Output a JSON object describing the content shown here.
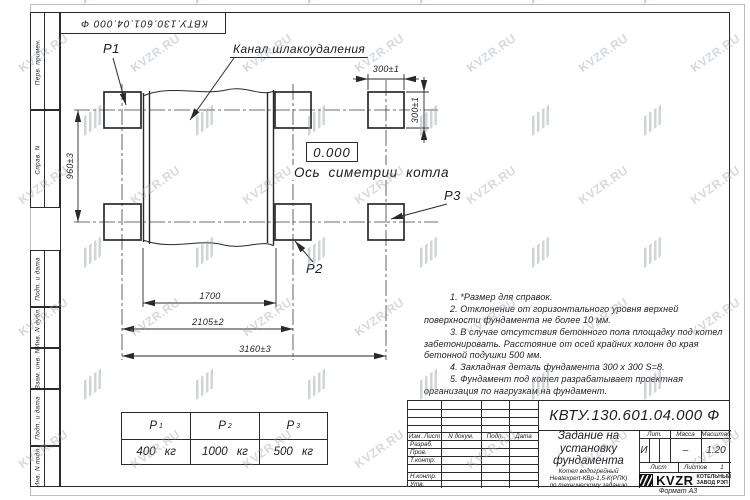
{
  "sheet": {
    "format_label": "Формат А3",
    "watermark_text": "KVZR.RU",
    "colors": {
      "line": "#2a2a2a",
      "watermark": "#96a0ac"
    }
  },
  "top_stamp": {
    "designation": "КВТУ.130.601.04.000  Ф"
  },
  "sidebar": {
    "labels": [
      "Перв. примен.",
      "Справ. N",
      "Подп. и дата",
      "Инв. N дубл.",
      "Взам. инв. N",
      "Подп. и дата",
      "Инв. N подл."
    ]
  },
  "drawing": {
    "channel_label": "Канал шлакоудаления",
    "level_mark": "0.000",
    "axis_label": "Ось симетрии котла",
    "points": {
      "p1": "P1",
      "p2": "P2",
      "p3": "P3"
    },
    "dims": {
      "height": "960±3",
      "pad_width": "300±1",
      "pad_height": "300±1",
      "channel_width": "1700",
      "mid_span": "2105±2",
      "overall": "3160±3"
    }
  },
  "notes": {
    "items": [
      "1. *Размер для справок.",
      "2. Отклонение от горизонтального уровня верхней поверхности фундамента не более 10 мм.",
      "3. В случае отсутствия бетонного пола площадку под котел забетонировать. Расстояние от осей крайних колонн до края бетонной подушки 500 мм.",
      "4. Закладная деталь фундамента  300 x 300  S=8.",
      "5. Фундамент под котел разрабатывает проектная организация по нагрузкам на фундамент."
    ]
  },
  "load_table": {
    "columns": [
      {
        "label": "P",
        "sub": "1",
        "value": "400 кг"
      },
      {
        "label": "P",
        "sub": "2",
        "value": "1000 кг"
      },
      {
        "label": "P",
        "sub": "3",
        "value": "500 кг"
      }
    ]
  },
  "title_block": {
    "designation": "КВТУ.130.601.04.000  Ф",
    "doc_title_lines": [
      "Задание на",
      "установку",
      "фундамента"
    ],
    "product_lines": [
      "Котел водогрейный",
      "Heatexpert-КВр-1,5-К(РПК)",
      "по техническому заданию"
    ],
    "header_cols": [
      "Изм. Лист",
      "N докум.",
      "Подп.",
      "Дата"
    ],
    "signature_rows": [
      "Разраб.",
      "Пров.",
      "Т.контр.",
      "Н.контр.",
      "Утв."
    ],
    "lit_label": "Лит.",
    "lit_value": "И",
    "mass_label": "Масса",
    "mass_value": "–",
    "scale_label": "Масштаб",
    "scale_value": "1:20",
    "sheet_label": "Лист",
    "sheets_label": "Листов",
    "sheets_value": "1",
    "company": {
      "abbr": "KVZR",
      "name_line1": "КОТЕЛЬНЫЙ",
      "name_line2": "ЗАВОД РЭП"
    }
  }
}
